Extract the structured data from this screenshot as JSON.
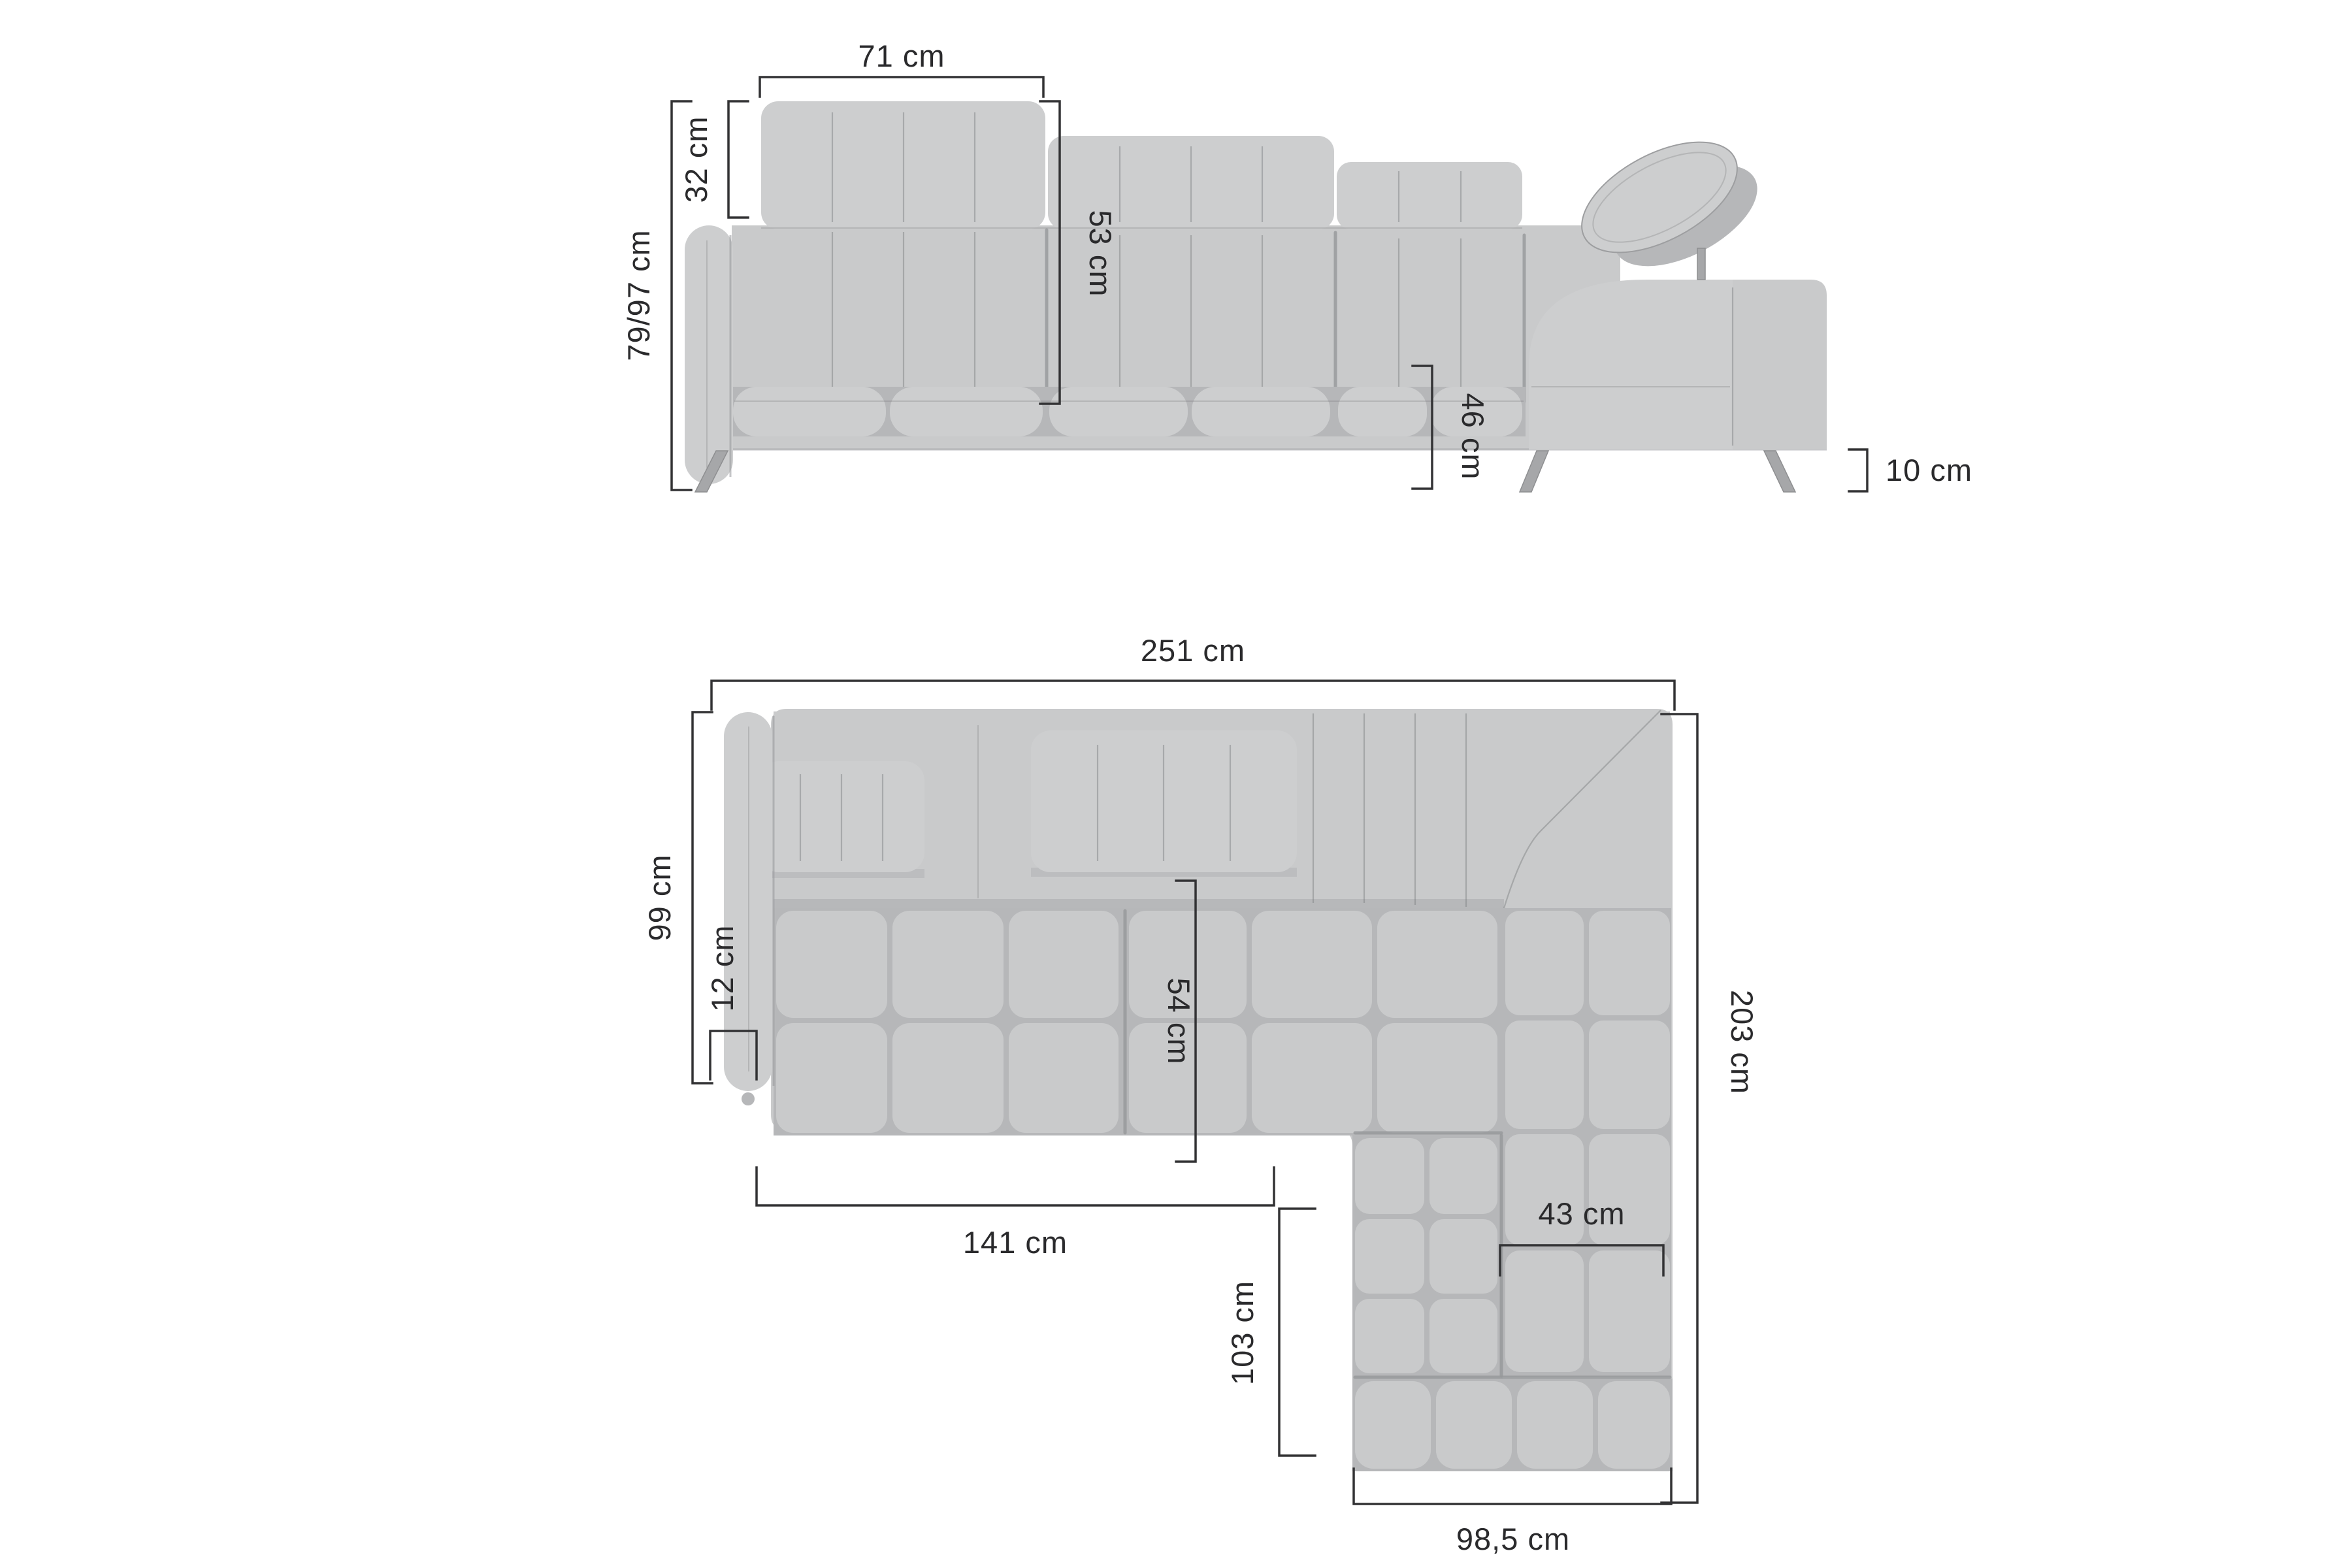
{
  "diagram_title": "corner-sofa-dimension-diagram",
  "unit": "cm",
  "colors": {
    "background": "#ffffff",
    "sofa": "#c9cacb",
    "sofa-light": "#cdcecf",
    "sofa-dark": "#b6b7b9",
    "sofa-deep": "#96979a",
    "seam": "#7b7c7e",
    "leg": "#a6a7a9",
    "dim-line": "#323234",
    "dim-text": "#2a2a2c"
  },
  "front_view": {
    "dims": {
      "headrest_width": "71 cm",
      "headrest_height": "32 cm",
      "total_height": "79/97 cm",
      "backrest_height": "53 cm",
      "seat_height": "46 cm",
      "leg_height": "10 cm"
    }
  },
  "top_view": {
    "dims": {
      "total_width": "251 cm",
      "side_depth": "99 cm",
      "armrest_width": "12 cm",
      "seat_depth": "54 cm",
      "seat_front_width": "141 cm",
      "total_depth": "203 cm",
      "corner_backrest_width": "43 cm",
      "chaise_length": "103 cm",
      "chaise_width": "98,5 cm"
    }
  }
}
